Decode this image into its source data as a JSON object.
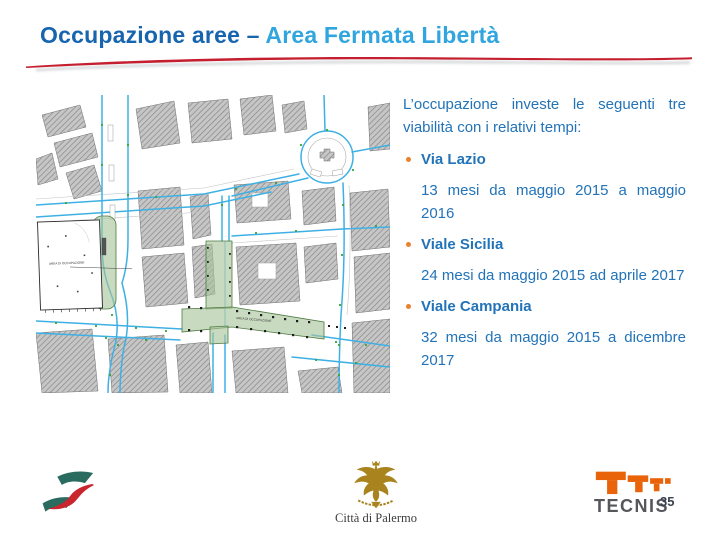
{
  "slide": {
    "title_prefix": "Occupazione aree – ",
    "title_highlight": "Area Fermata Libertà",
    "page_number": "35"
  },
  "content": {
    "intro": "L’occupazione investe le seguenti tre viabilità con i relativi tempi:",
    "items": [
      {
        "name": "Via Lazio",
        "duration": "13 mesi da maggio 2015 a maggio 2016"
      },
      {
        "name": "Viale Sicilia",
        "duration": "24 mesi da maggio 2015 ad aprile 2017"
      },
      {
        "name": "Viale Campania",
        "duration": "32 mesi da maggio 2015 a dicembre 2017"
      }
    ]
  },
  "map": {
    "labels": {
      "area_left": "AREA DI OCCUPAZIONE",
      "area_center": "AREA DI OCCUPAZIONE"
    }
  },
  "footer": {
    "palermo_label": "Città di Palermo",
    "tecnis_label": "TECNIS"
  },
  "colors": {
    "title_dark_blue": "#1665AE",
    "title_light_blue": "#31A5DE",
    "body_blue": "#2273B8",
    "bullet_orange": "#E8822D",
    "swoosh_red": "#C41E2F",
    "map_green": "#A6C49A",
    "road_blue": "#3EB0E4",
    "fs_teal": "#2A6B60",
    "fs_red": "#C8252F",
    "palermo_gold": "#A8831E",
    "tecnis_orange": "#E8630A"
  }
}
